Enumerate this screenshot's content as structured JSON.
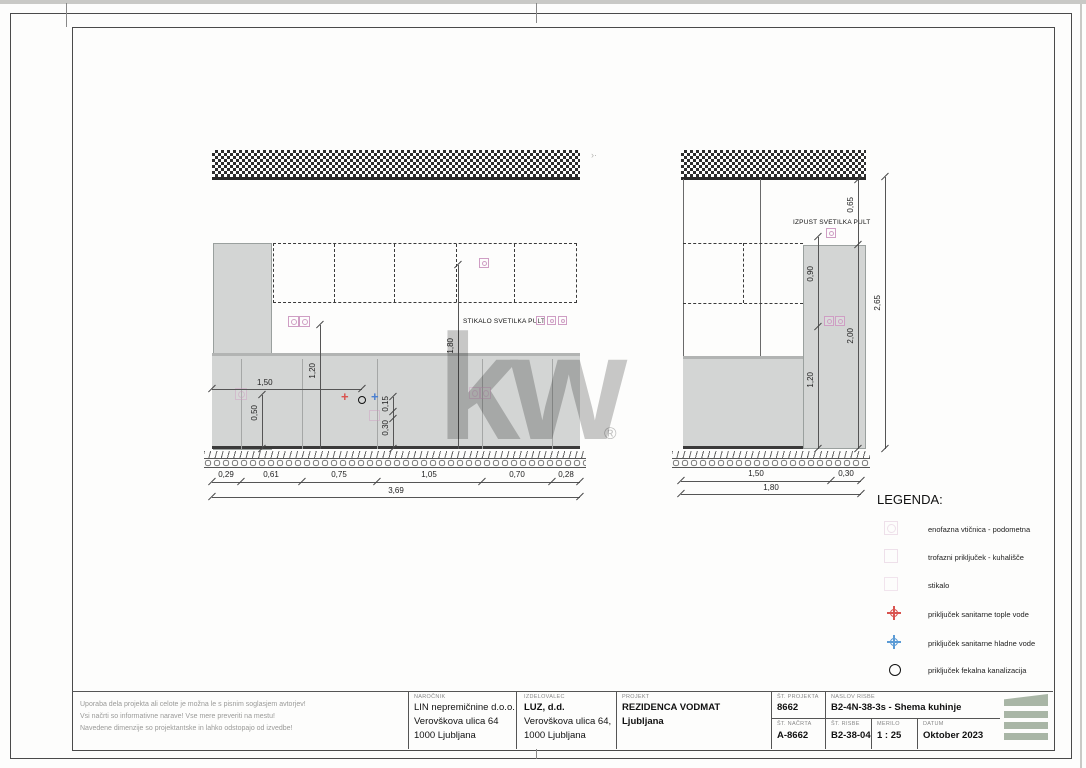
{
  "sheet": {
    "watermark": "kw",
    "registered": "®"
  },
  "left_drawing": {
    "switch_label": "STIKALO SVETILKA PULT",
    "dims": {
      "h150": "1,50",
      "v120": "1,20",
      "v180": "1,80",
      "v050": "0,50",
      "v015": "0,15",
      "v030": "0,30",
      "chain": [
        "0,29",
        "0,61",
        "0,75",
        "1,05",
        "0,70",
        "0,28"
      ],
      "total": "3,69"
    }
  },
  "right_drawing": {
    "outlet_label": "IZPUST SVETILKA PULT",
    "dims": {
      "v065": "0,65",
      "v090": "0,90",
      "v200": "2,00",
      "v120": "1,20",
      "v265": "2,65",
      "chain": [
        "1,50",
        "0,30"
      ],
      "total": "1,80"
    }
  },
  "legend": {
    "title": "LEGENDA:",
    "items": [
      {
        "symbol": "single-phase-socket-icon",
        "label": "enofazna vtičnica - podometna"
      },
      {
        "symbol": "three-phase-connection-icon",
        "label": "trofazni priključek - kuhališče"
      },
      {
        "symbol": "switch-icon",
        "label": "stikalo"
      },
      {
        "symbol": "hot-water-connection-icon",
        "label": "priključek sanitarne tople vode"
      },
      {
        "symbol": "cold-water-connection-icon",
        "label": "priključek sanitarne hladne vode"
      },
      {
        "symbol": "sewage-connection-icon",
        "label": "priključek fekalna kanalizacija"
      }
    ]
  },
  "title_block": {
    "disclaimer": [
      "Uporaba dela projekta ali celote je možna le s pisnim soglasjem avtorjev!",
      "Vsi načrti so informativne narave! Vse mere preveriti na mestu!",
      "Navedene dimenzije so projektantske in lahko odstopajo od izvedbe!"
    ],
    "narocnik": {
      "label": "NAROČNIK",
      "line1": "LIN nepremičnine d.o.o.",
      "line2": "Verovškova ulica 64",
      "line3": "1000 Ljubljana"
    },
    "izdelovalec": {
      "label": "IZDELOVALEC",
      "line1": "LUZ, d.d.",
      "line2": "Verovškova ulica 64,",
      "line3": "1000 Ljubljana"
    },
    "projekt": {
      "label": "PROJEKT",
      "line1": "REZIDENCA VODMAT",
      "line2": "Ljubljana"
    },
    "st_projekta": {
      "label": "ŠT. PROJEKTA",
      "value": "8662"
    },
    "naslov_risbe": {
      "label": "NASLOV RISBE",
      "value": "B2-4N-38-3s - Shema kuhinje"
    },
    "st_nacrta": {
      "label": "ŠT. NAČRTA",
      "value": "A-8662"
    },
    "st_risbe": {
      "label": "ŠT. RISBE",
      "value": "B2-38-04"
    },
    "merilo": {
      "label": "MERILO",
      "value": "1 : 25"
    },
    "datum": {
      "label": "DATUM",
      "value": "Oktober 2023"
    }
  },
  "colors": {
    "symbol_pink": "#cf9ec4",
    "hot_water": "#d9534f",
    "cold_water": "#5b9bd5",
    "cabinet_gray": "#d3d5d4",
    "logo_green": "#a9b6a6"
  }
}
